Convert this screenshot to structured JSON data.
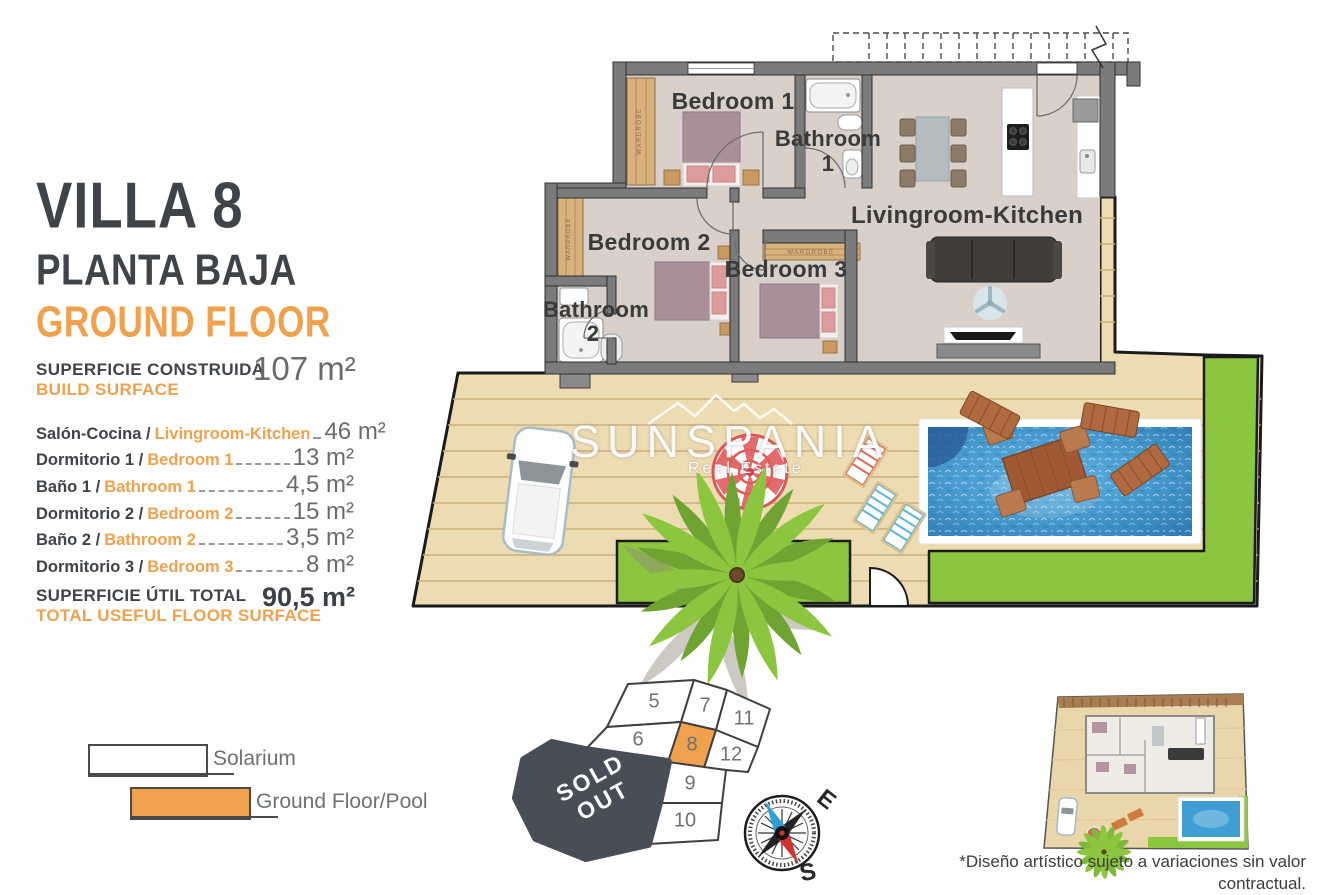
{
  "meta": {
    "accent_orange": "#F0A14D",
    "dark_text": "#3F4449",
    "value_gray": "#696C6F",
    "grass_green": "#8CC63E",
    "pool_blue": "#4498CC",
    "deck_tan": "#EDDCB1",
    "wall_gray": "#7B7B7B",
    "sold_out_bg": "#474E57"
  },
  "header": {
    "title": "VILLA 8",
    "subtitle_es": "PLANTA BAJA",
    "subtitle_en": "GROUND FLOOR"
  },
  "build_surface": {
    "label_es": "SUPERFICIE CONSTRUIDA",
    "label_en": "BUILD SURFACE",
    "value": "107 m²"
  },
  "rooms": [
    {
      "es": "Salón-Cocina /",
      "en": "Livingroom-Kitchen",
      "value": "46 m²"
    },
    {
      "es": "Dormitorio 1 /",
      "en": "Bedroom 1",
      "value": "13 m²"
    },
    {
      "es": "Baño 1 /",
      "en": "Bathroom 1",
      "value": "4,5 m²"
    },
    {
      "es": "Dormitorio 2 /",
      "en": "Bedroom 2",
      "value": "15 m²"
    },
    {
      "es": "Baño 2 /",
      "en": "Bathroom 2",
      "value": "3,5 m²"
    },
    {
      "es": "Dormitorio 3 /",
      "en": "Bedroom 3",
      "value": "8 m²"
    }
  ],
  "total": {
    "label_es": "SUPERFICIE ÚTIL TOTAL",
    "label_en": "TOTAL USEFUL FLOOR SURFACE",
    "value": "90,5 m²"
  },
  "plan": {
    "bedroom1": "Bedroom 1",
    "bathroom1_l1": "Bathroom",
    "bathroom1_l2": "1",
    "bedroom2": "Bedroom 2",
    "bedroom3": "Bedroom 3",
    "bathroom2_l1": "Bathroom",
    "bathroom2_l2": "2",
    "living": "Livingroom-Kitchen",
    "wardrobe": "WARDROBE"
  },
  "watermark": {
    "name": "SUNSPANIA",
    "tagline": "Real Estate"
  },
  "legend": [
    {
      "label": "Solarium",
      "swatch": "#FFFFFF"
    },
    {
      "label": "Ground Floor/Pool",
      "swatch": "#F0A14D"
    }
  ],
  "site_plan": {
    "sold_out": "SOLD OUT",
    "highlighted_plot": "8",
    "plots": [
      {
        "n": "5"
      },
      {
        "n": "7"
      },
      {
        "n": "11"
      },
      {
        "n": "6"
      },
      {
        "n": "8"
      },
      {
        "n": "12"
      },
      {
        "n": "9"
      },
      {
        "n": "10"
      }
    ]
  },
  "compass": {
    "east": "E",
    "south": "S"
  },
  "disclaimer": {
    "line1": "*Diseño artístico sujeto a variaciones sin valor contractual.",
    "line2": "Muebles y paneles solares no incluidos."
  }
}
